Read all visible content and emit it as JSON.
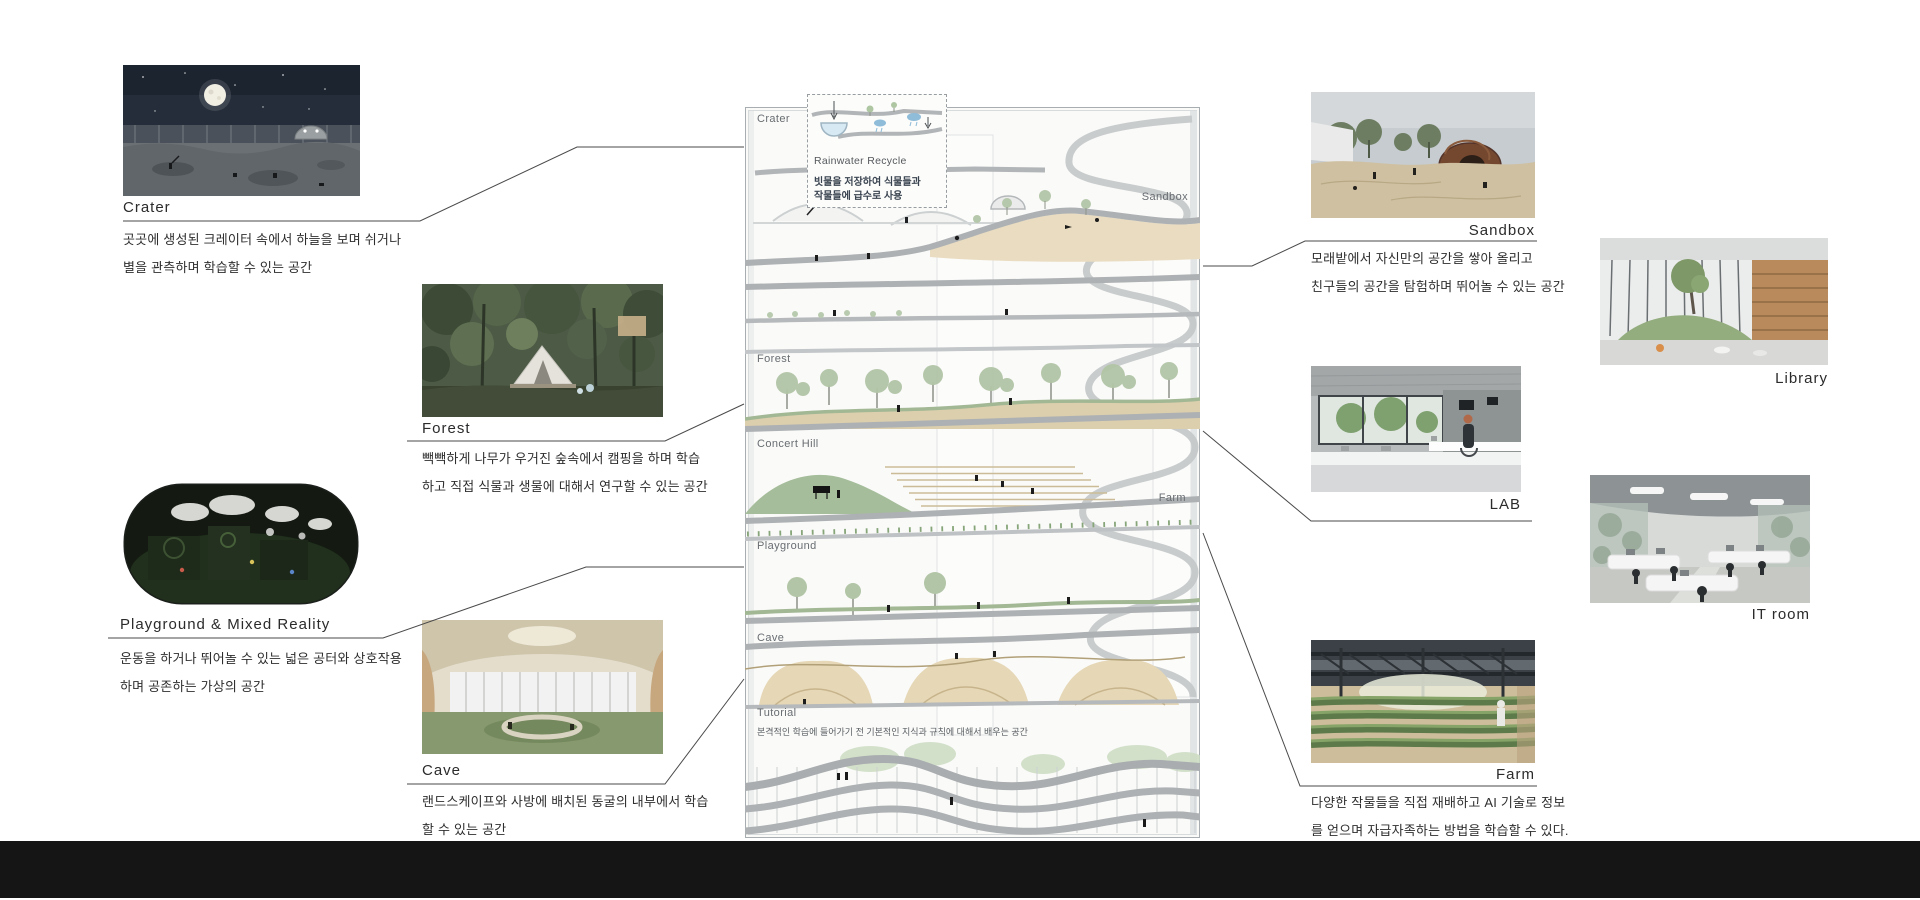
{
  "board": {
    "left": {
      "crater": {
        "label": "Crater",
        "desc1": "곳곳에 생성된 크레이터 속에서 하늘을 보며 쉬거나",
        "desc2": "별을 관측하며 학습할 수 있는 공간"
      },
      "forest": {
        "label": "Forest",
        "desc1": "빽빽하게 나무가 우거진 숲속에서 캠핑을 하며 학습",
        "desc2": "하고 직접 식물과 생물에 대해서 연구할 수 있는 공간"
      },
      "playground": {
        "label": "Playground & Mixed Reality",
        "desc1": "운동을 하거나 뛰어놀 수 있는 넓은 공터와 상호작용",
        "desc2": "하며 공존하는 가상의 공간"
      },
      "cave": {
        "label": "Cave",
        "desc1": "랜드스케이프와 사방에 배치된 동굴의 내부에서 학습",
        "desc2": "할 수 있는 공간"
      }
    },
    "right": {
      "sandbox": {
        "label": "Sandbox",
        "desc1": "모래밭에서 자신만의 공간을 쌓아 올리고",
        "desc2": "친구들의 공간을 탐험하며 뛰어놀 수 있는 공간"
      },
      "library": {
        "label": "Library"
      },
      "lab": {
        "label": "LAB"
      },
      "it_room": {
        "label": "IT room"
      },
      "farm": {
        "label": "Farm",
        "desc1": "다양한 작물들을 직접 재배하고 AI 기술로 정보",
        "desc2": "를 얻으며 자급자족하는 방법을 학습할 수 있다."
      }
    },
    "section": {
      "crater": "Crater",
      "sandbox": "Sandbox",
      "forest": "Forest",
      "concert_hill": "Concert Hill",
      "farm": "Farm",
      "playground": "Playground",
      "cave": "Cave",
      "tutorial": "Tutorial",
      "tutorial_desc": "본격적인 학습에 들어가기 전 기본적인 지식과 규칙에 대해서 배우는 공간",
      "rainwater_title": "Rainwater Recycle",
      "rainwater_desc1": "빗물을 저장하여 식물들과",
      "rainwater_desc2": "작물들에 급수로 사용"
    },
    "colors": {
      "slab_gray": "#b2b5b7",
      "sand": "#e9dcc0",
      "green": "#a2b794",
      "footer": "#151515"
    }
  }
}
